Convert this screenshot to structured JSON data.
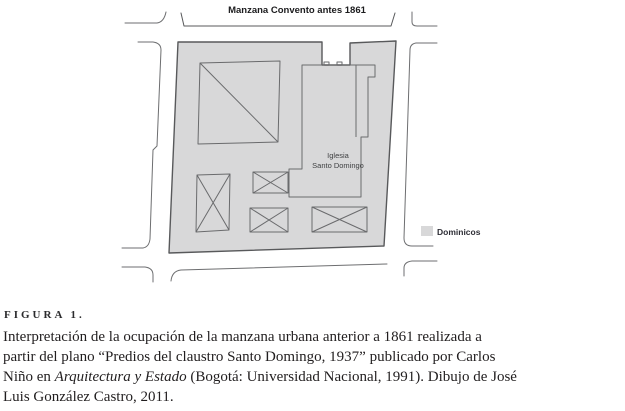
{
  "figure": {
    "map": {
      "title": "Manzana Convento antes 1861",
      "church_label_line1": "Iglesia",
      "church_label_line2": "Santo Domingo",
      "legend": {
        "label": "Dominicos",
        "swatch_color": "#d8d8d9"
      }
    },
    "colors": {
      "block_fill": "#d8d8d9",
      "block_outline": "#58595b",
      "building_outline": "#6a6b6d",
      "street_line": "#6d6e70",
      "caption_text": "#211e1f"
    },
    "caption": {
      "figure_label": "FIGURA 1.",
      "line1": "Interpretación de la ocupación de la manzana urbana anterior a 1861 realizada a",
      "line2": "partir del plano “Predios del claustro Santo Domingo, 1937” publicado por Carlos",
      "line3_pre": "Niño en ",
      "line3_italic": "Arquitectura y Estado",
      "line3_post": " (Bogotá: Universidad Nacional, 1991). Dibujo de José",
      "line4": "Luis González Castro, 2011."
    }
  }
}
